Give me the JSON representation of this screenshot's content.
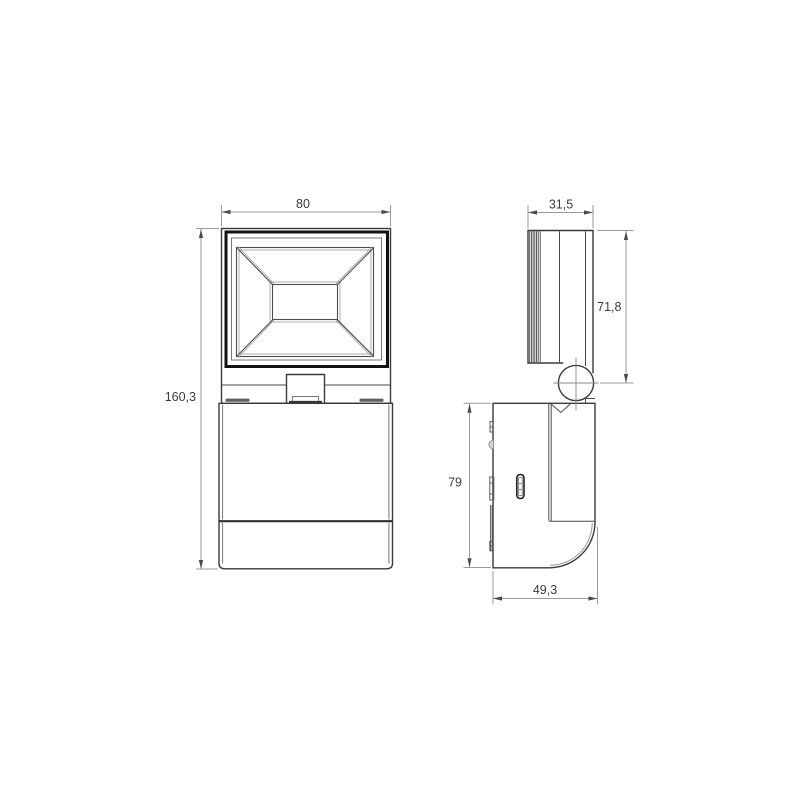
{
  "drawing": {
    "type": "technical-dimension-drawing",
    "views": [
      "front-view",
      "side-view"
    ]
  },
  "dims": {
    "front_width": "80",
    "front_height": "160,3",
    "head_depth": "31,5",
    "head_height": "71,8",
    "base_height": "79",
    "base_depth": "49,3"
  },
  "colors": {
    "background": "#ffffff",
    "object_line": "#3a3a3a",
    "frame_line": "#121212",
    "seam_line": "#4a4a4a",
    "dim_line": "#9a9a9a",
    "arrow": "#4a4a4a",
    "text": "#3b3b3d"
  }
}
